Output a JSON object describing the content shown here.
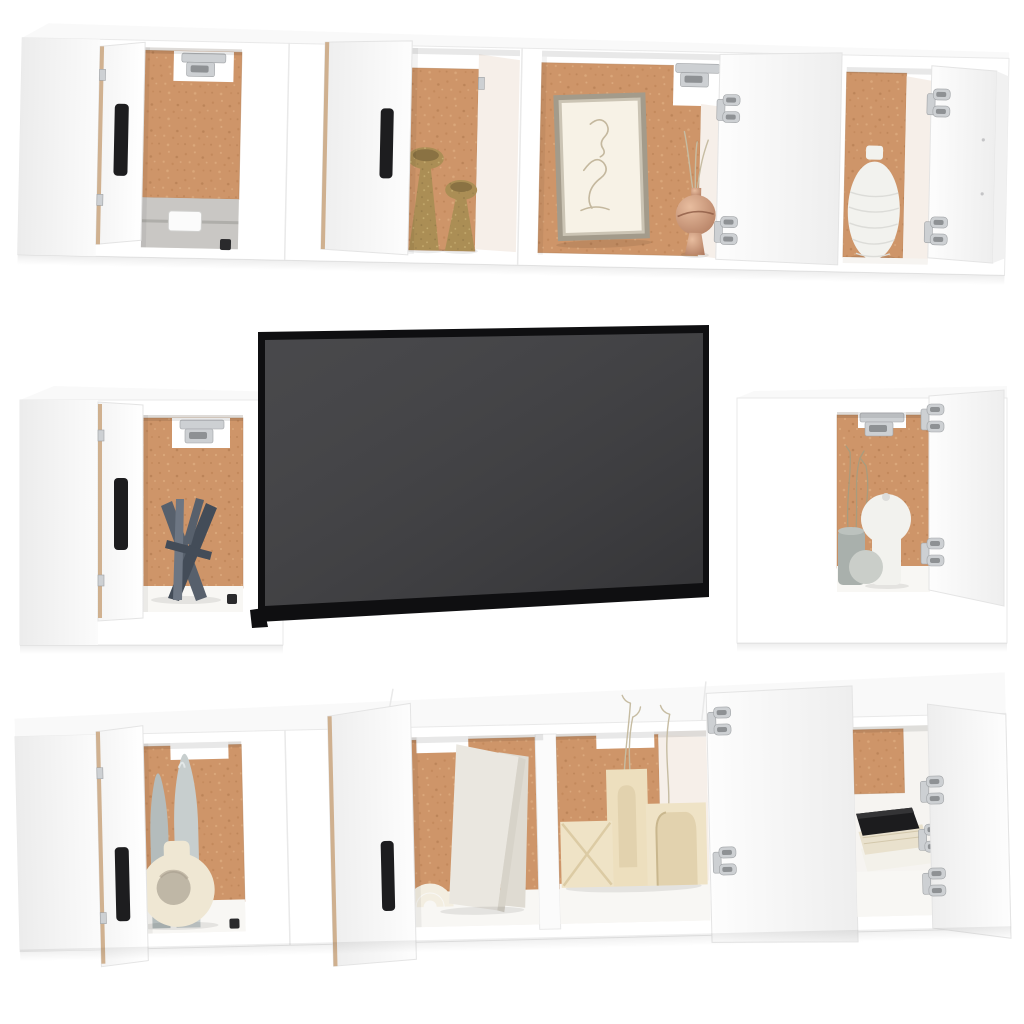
{
  "scene": {
    "type": "furniture product photo on white background",
    "subject": "White wall-mounted TV cabinet set (8 pieces) with flat-screen television and decor",
    "rows": [
      {
        "name": "top wall cabinet row",
        "units": 4,
        "open_doors": 4,
        "decor": [
          "grey concrete ledge with white plate",
          "two gold goblet candle holders",
          "framed beige line-art portrait",
          "rose-gold vase with dried stems",
          "white textured vase"
        ]
      },
      {
        "name": "middle row",
        "items": [
          "square wall cabinet with dark grey abstract sculpture",
          "flat-screen television, dark grey screen with black bezel",
          "square wall cabinet with white round vase, grey sphere, grey pot and dried grass"
        ]
      },
      {
        "name": "bottom TV stand row",
        "units": 2,
        "compartments": 4,
        "open_doors": 4,
        "decor": [
          "two grey bottle vases",
          "cream ring-shaped vase",
          "cream double-arch ornament",
          "two leaning blank canvases",
          "three cream arch candle blocks",
          "dried flower stems",
          "stack of books with black top book"
        ]
      }
    ],
    "interior_back_material": "cork / mdf brown panel",
    "hardware": [
      "silver concealed hinges",
      "black vertical bar handles"
    ]
  },
  "colors": {
    "background": "#ffffff",
    "cabinet_white": "#ffffff",
    "edge": "#e9e9e9",
    "wood_edge": "#c9a47e",
    "handle": "#1d1d1f",
    "hinge": "#cdd0d3",
    "hinge_dark": "#8e9194",
    "cork": "#ce9569",
    "cork_dark": "#b97f52",
    "cork_light": "#e2b286",
    "interior_wall": "#f6efe9",
    "concrete": "#c9c7c4",
    "concrete_dark": "#9e9c99",
    "tv_bezel": "#0f0f11",
    "tv_screen": "#3b3b3e",
    "gold": "#ab8e55",
    "gold_dark": "#8a7243",
    "rose_gold": "#c28e74",
    "rose_gold_light": "#e8bd9f",
    "frame": "#a39b8b",
    "frame_mat": "#f7f2e6",
    "art_line": "#c4b89e",
    "white_vase": "#f2f2ee",
    "gray_sculpture": "#57606c",
    "gray_sculpture_dark": "#434c58",
    "cream_ceramic": "#efe7d3",
    "bottle_gray_1": "#b4bcbc",
    "bottle_gray_2": "#c7cece",
    "canvas": "#eae7e0",
    "canvas_edge": "#d7d3c9",
    "arch_cream": "#f3eee1",
    "candle_cream_1": "#efe3c6",
    "candle_cream_2": "#eddfbe",
    "candle_inset": "#e2d2ae",
    "book_black": "#1c1c1e",
    "book_cream": "#e9e1cd",
    "book_white": "#f3f1ea",
    "grass": "#a89c7e",
    "logo": "#2a2a2c"
  }
}
